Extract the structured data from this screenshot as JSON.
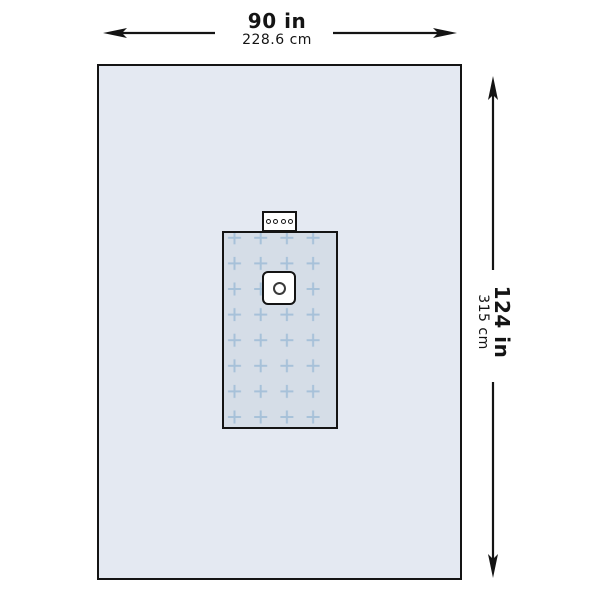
{
  "dimensions": {
    "width": {
      "inches": "90 in",
      "centimeters": "228.6 cm"
    },
    "height": {
      "inches": "124 in",
      "centimeters": "315 cm"
    }
  },
  "colors": {
    "background": "#ffffff",
    "drape_fill": "#e4e9f2",
    "reinforcement_fill": "#d5dde7",
    "cross_pattern": "#a7c1d9",
    "outline": "#141414",
    "fenestration_ring": "#3a3a3a"
  },
  "icons": {
    "width_arrows": [
      "arrow-left-icon",
      "arrow-right-icon"
    ],
    "height_arrows": [
      "arrow-up-icon",
      "arrow-down-icon"
    ]
  },
  "reinforcement_pattern": {
    "type": "crosses",
    "columns": 4,
    "rows": 8
  },
  "tube_holder": {
    "hole_count": 4
  }
}
